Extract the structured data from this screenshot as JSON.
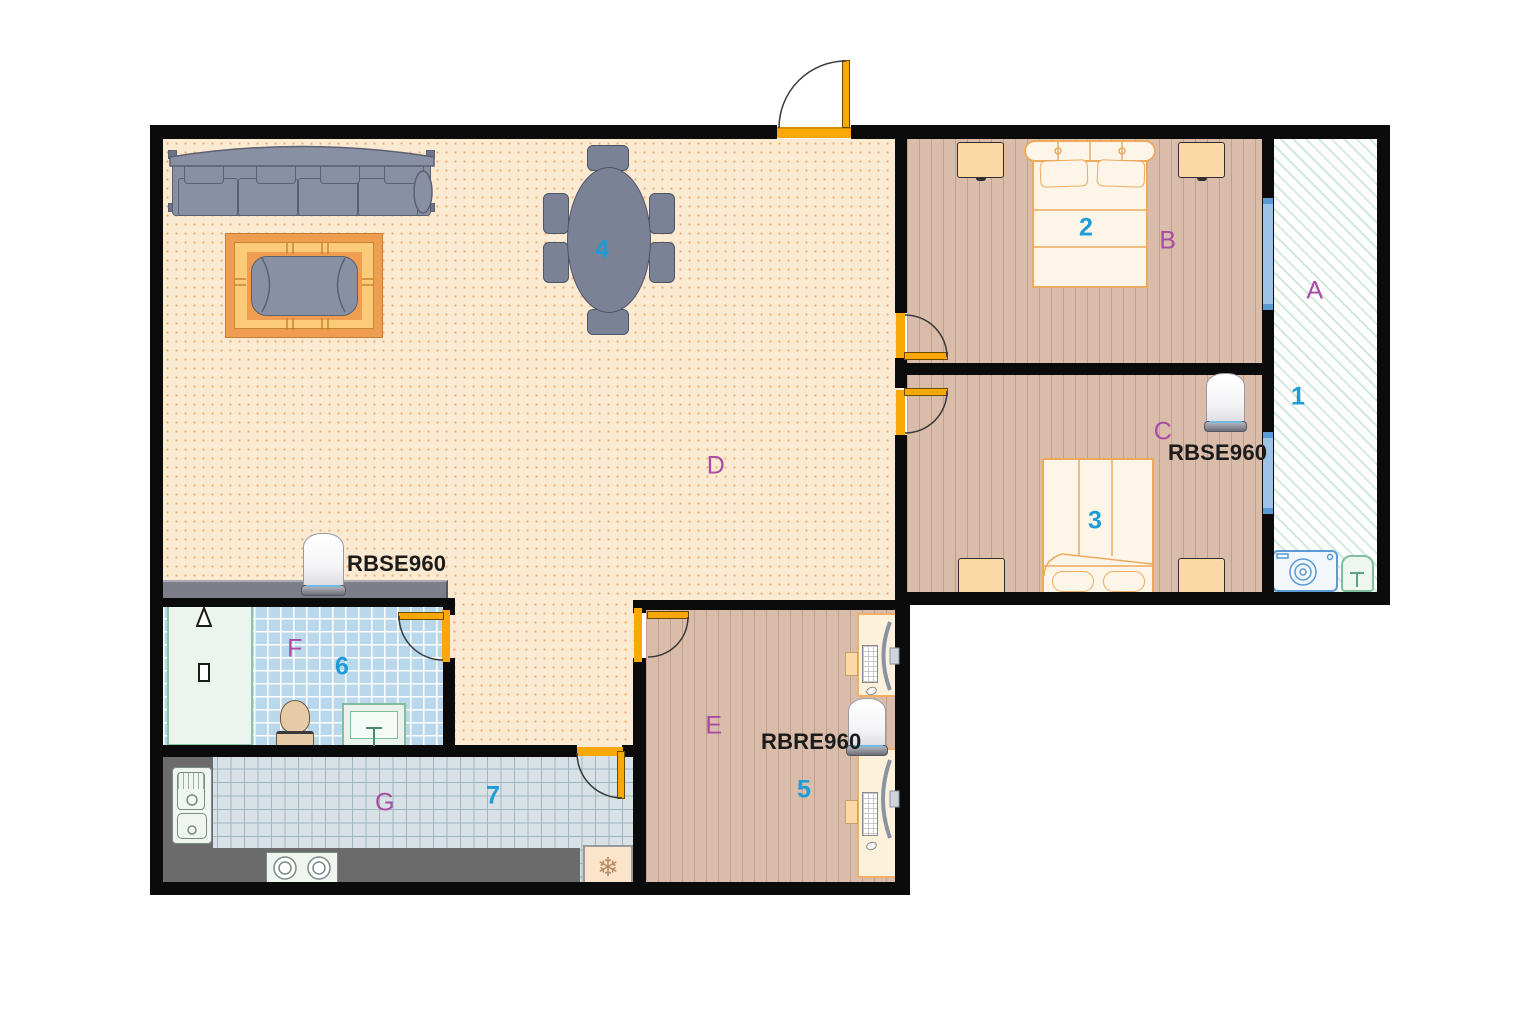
{
  "title": "Apartment floor plan with mesh WiFi router placement",
  "rooms": {
    "a": {
      "letter": "A",
      "number": "1",
      "type": "balcony"
    },
    "b": {
      "letter": "B",
      "number": "2",
      "type": "bedroom"
    },
    "c": {
      "letter": "C",
      "number": "3",
      "type": "bedroom"
    },
    "d": {
      "letter": "D",
      "number": "4",
      "type": "living-dining-room"
    },
    "e": {
      "letter": "E",
      "number": "5",
      "type": "office"
    },
    "f": {
      "letter": "F",
      "number": "6",
      "type": "bathroom"
    },
    "g": {
      "letter": "G",
      "number": "7",
      "type": "kitchen"
    }
  },
  "devices": {
    "living_router": "RBSE960",
    "bedroom_c_router": "RBSE960",
    "office_router": "RBRE960"
  },
  "icons": {
    "fridge_snowflake": "❄"
  },
  "colors": {
    "wall": "#0b0b0b",
    "door": "#F9A808",
    "living_floor": "#FBEAD2",
    "wood_floor": "#D9BCAA",
    "balcony_hatch": "#8CC8AC",
    "bath_tile": "#B9D8EC",
    "kitchen_tile": "#D8E2E6",
    "counter_gray": "#6B6B6B",
    "letter_purple": "#A84BA5",
    "number_blue": "#1E9CD7",
    "window_blue": "#9DC3E6"
  }
}
